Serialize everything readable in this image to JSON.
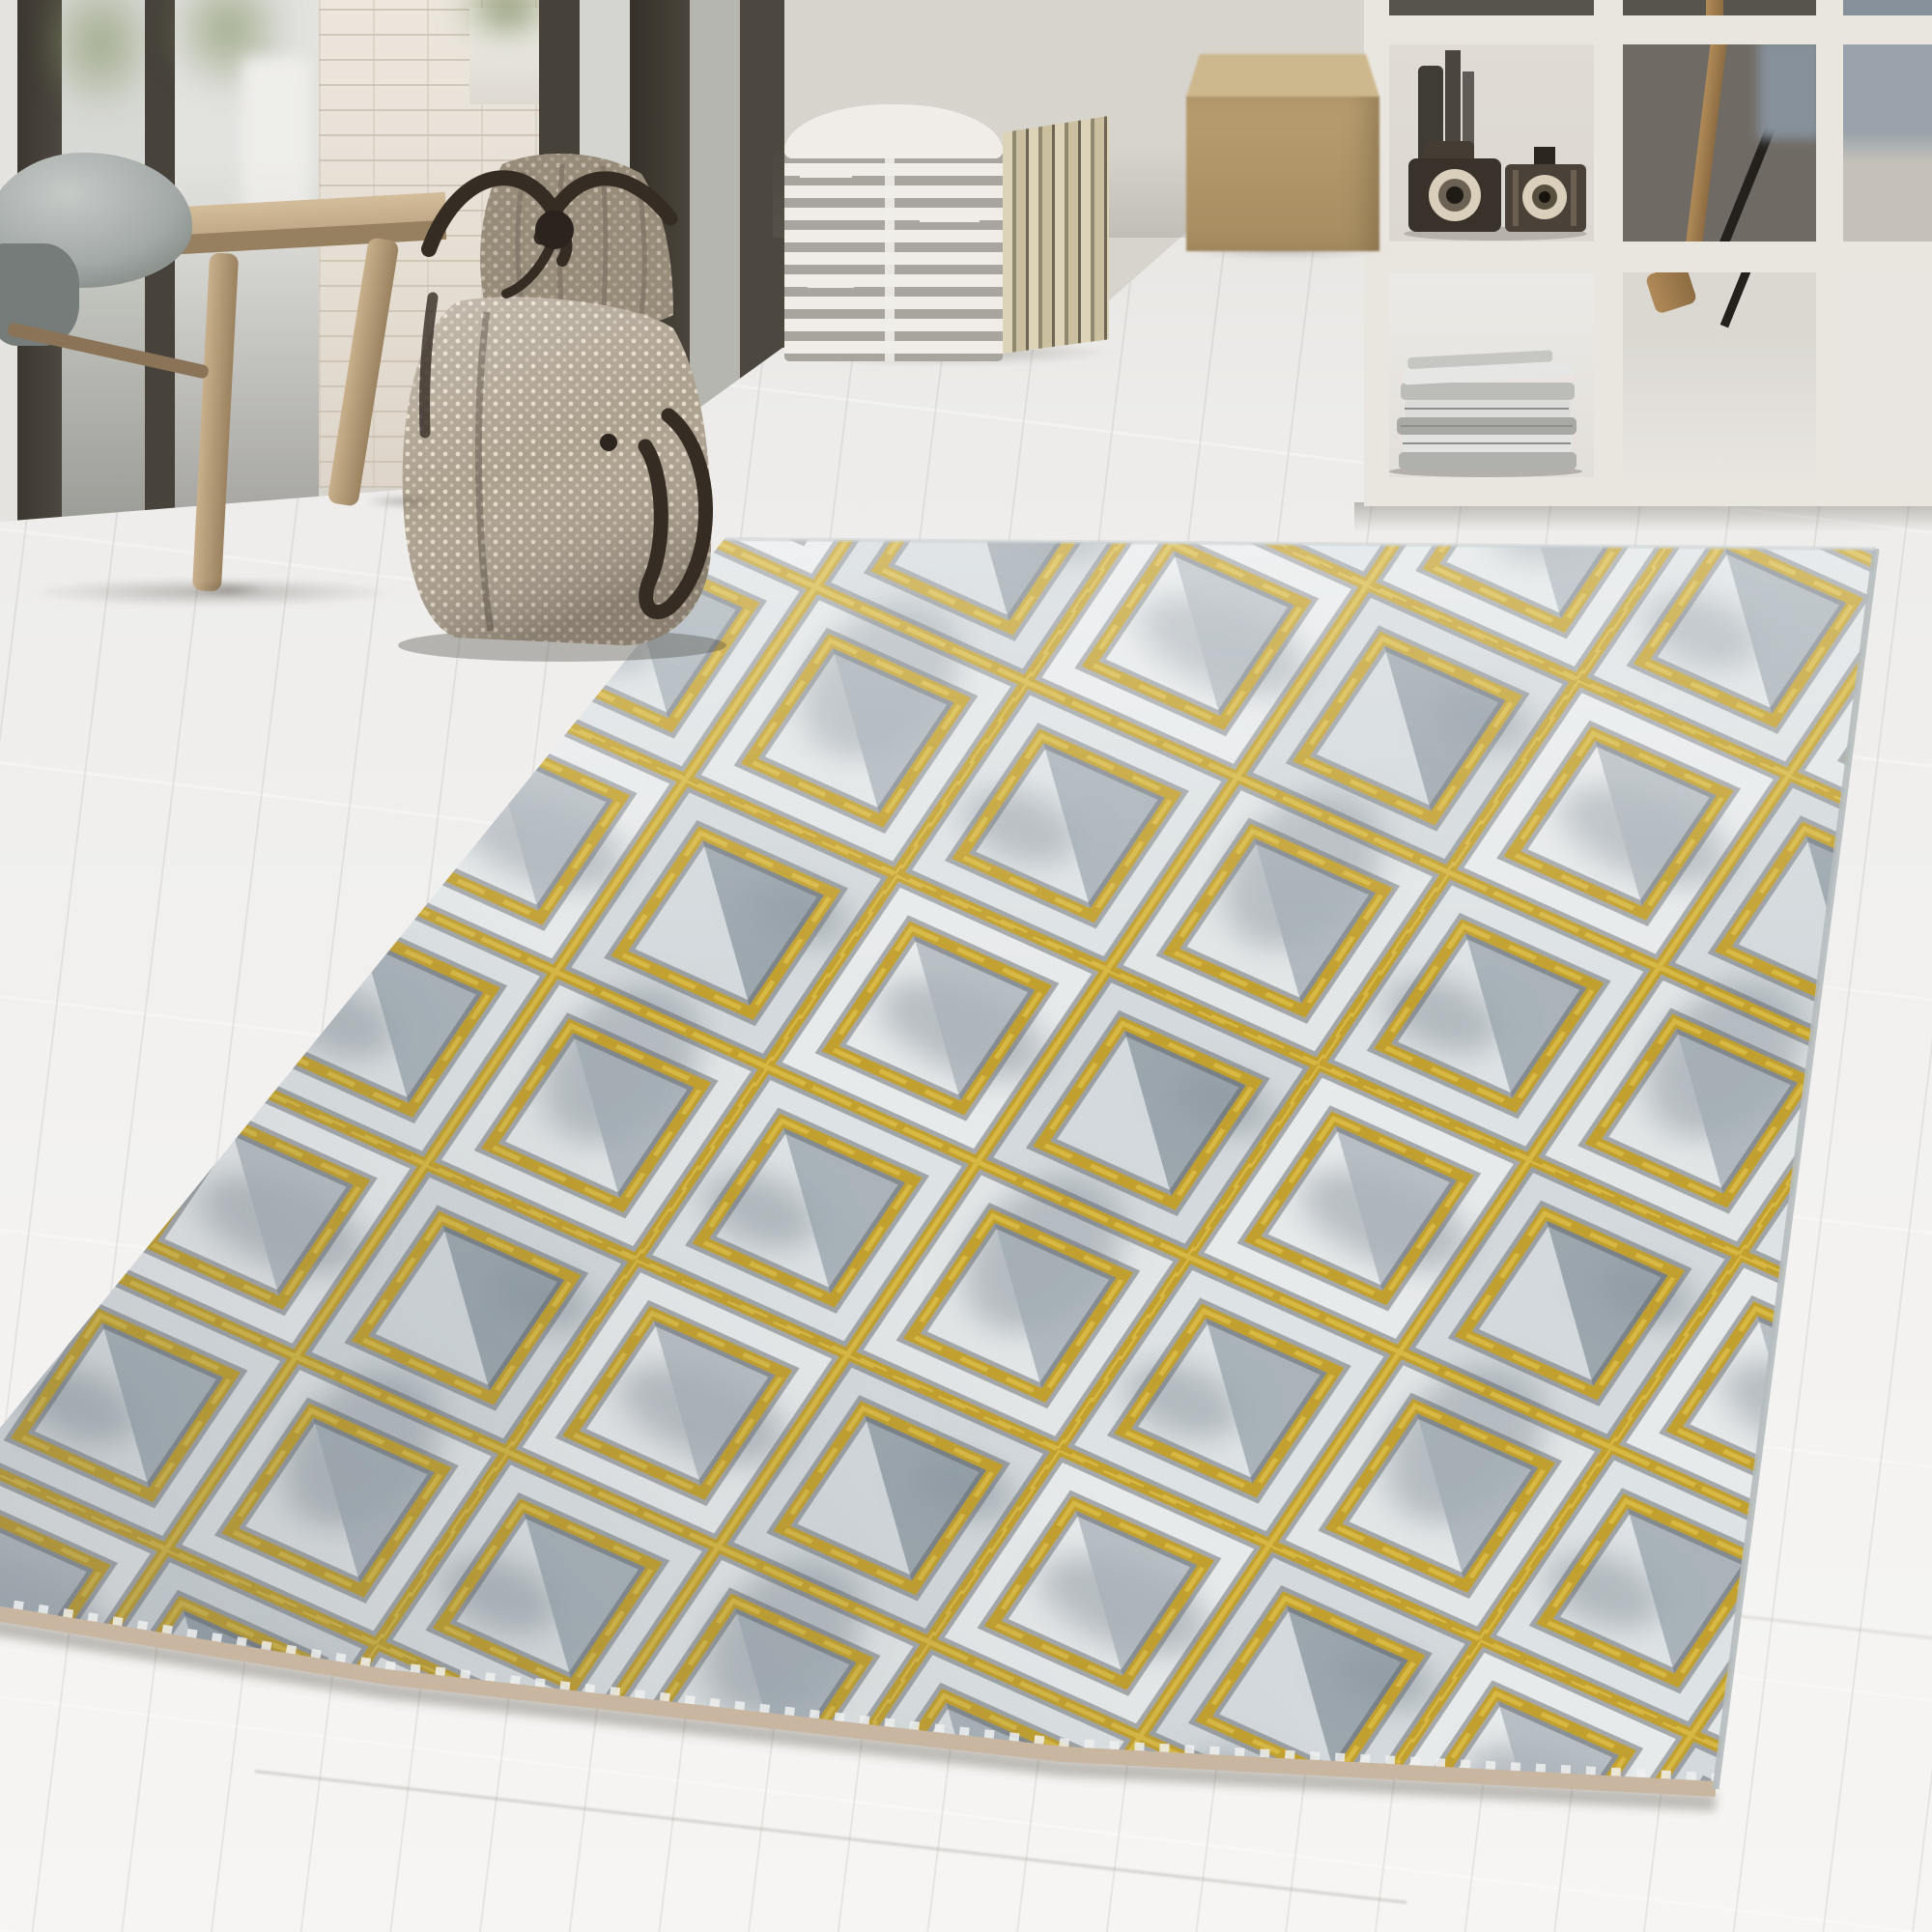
{
  "image_kind": "interior product photograph, no visible text",
  "scene": {
    "setting": "bright living room corner with dark-framed floor-to-ceiling windows, a white brick wall section, pale whitewashed wood-plank floor and a light gray back wall",
    "objects": [
      {
        "name": "window-wall",
        "description": "dark brown-gray mullioned glass doors with blurry greenery and white planters outside"
      },
      {
        "name": "brick-wall",
        "description": "white painted brick pier with a small white planter and green plant on top"
      },
      {
        "name": "wooden-bench",
        "description": "rustic light-wood bench with splayed round legs, gray quilted cushion and folded gray cloth"
      },
      {
        "name": "duffel-bag",
        "description": "beige woven dot-textured weekender bag with dark brown straps, knotted handle and hanging loop, standing on the floor"
      },
      {
        "name": "striped-pouf",
        "description": "white cube pouf with broken gray horizontal stripes and tan striped side"
      },
      {
        "name": "tan-pouf",
        "description": "plain tan-khaki cube pouf"
      },
      {
        "name": "cube-shelf",
        "description": "white open cube shelving unit holding two vintage cameras, dark bottles and a stack of folded newspapers"
      },
      {
        "name": "easel",
        "description": "wooden easel legs and a black rod seen through the open shelf"
      },
      {
        "name": "rug",
        "description": "rectangular rug lying at an angle across the floor"
      }
    ]
  },
  "rug": {
    "pattern": "diagonal gold lattice of squares, each cell holding a concentric inset gold square",
    "material_look": "marbled light-gray and graphite pile with raised metallic gold relief lines and shaded triangular facets",
    "edge": "tan selvage binding along the near edge, pale gray bound side edge",
    "orientation": "far edge nearly horizontal mid-frame, near corner toward bottom right"
  },
  "palette": {
    "wall": "#d7d3cd",
    "outdoor": "#e4e3df",
    "frame_dark": "#45413a",
    "glass": "#caccc6",
    "plant": "#7f8d62",
    "floor": "#f0efec",
    "wood": "#c6ae8a",
    "pillow": "#a3a9a7",
    "cloth": "#767c79",
    "bag_base": "#ab9f8d",
    "bag_dot": "#e6ddcc",
    "strap": "#352c24",
    "pouf_white": "#f0ede8",
    "pouf_stripe": "#a8a49e",
    "cube_top": "#cdb78d",
    "cube_front": "#a68c60",
    "shelf_frame": "#e9e5df",
    "shelf_cell_light": "#dcd7d1",
    "shelf_cell_dark": "#6f6a63",
    "camera_dark": "#38322a",
    "camera_cream": "#d9cfba",
    "news_light": "#e2e2e0",
    "news_dark": "#b0b0ac",
    "easel_wood": "#b08a58",
    "easel_stick": "#24211d",
    "chair_blue": "#87919b",
    "rug_light": "#e7eaeb",
    "rug_cell_b": "#d3d9dc",
    "rug_cell_c": "#dde2e4",
    "rug_cell_d": "#e2e6e7",
    "rug_inner_a": "#aab3ba",
    "rug_inner_b": "#8c97a0",
    "rug_inner_c": "#9aa5ad",
    "rug_inner_d": "#a2acb3",
    "rug_smudge": "#76828c",
    "gold": "#c2a02f",
    "gold_bright": "#d9ba44",
    "line_shadow": "#54585c",
    "selvage": "#c8b6a1",
    "rug_edge": "#b6bcbe"
  }
}
